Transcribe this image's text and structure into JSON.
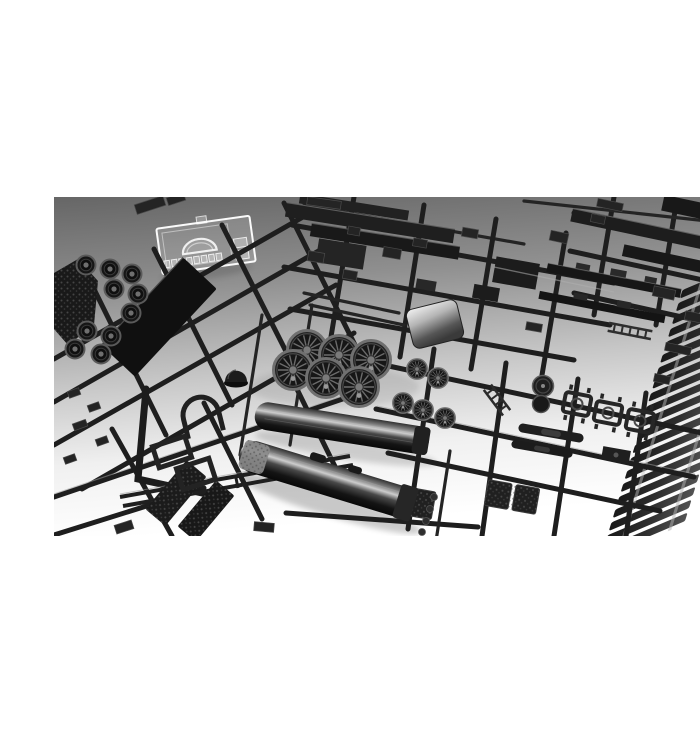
{
  "page": {
    "background": "#ffffff",
    "alt": "Product photograph of black injection-moulded plastic model-kit sprues for a steam locomotive: runners with spoked driver wheels, two glossy boiler halves, tender floor and side panels, coal load, smokebox door, ladders, bogie frames, a flexible track section with sleepers, and one clear glazing sprue, laid on a gray-to-white studio background."
  },
  "photo": {
    "description": "Steam locomotive model kit sprues on gradient studio backdrop",
    "background_top": "#666666",
    "background_upper": "#8f8f8f",
    "background_mid": "#c6c6c6",
    "background_lower": "#f0f0f0",
    "background_bottom": "#ffffff",
    "colors": {
      "plastic": "#1e1e1e",
      "plastic_highlight": "#9a9a9a",
      "clear_part": "#fafafa",
      "boiler_edge": "#303030",
      "boiler_light": "#7a7a7a",
      "boiler_sheen": "#cdcdcd",
      "boiler_mid": "#494949",
      "boiler_dark": "#141414",
      "boiler_deep": "#090909",
      "metal_bright": "#f2f2f2",
      "metal_mid": "#b5b5b5",
      "metal_shadow": "#565656",
      "metal_deep": "#3a3a3a",
      "tie_light": "#525252",
      "tie_mid": "#2e2e2e",
      "tie_dark": "#191919"
    },
    "parts": [
      {
        "label": "clear glazing sprue"
      },
      {
        "label": "tender disc wheels"
      },
      {
        "label": "coal load insert"
      },
      {
        "label": "tender floor panel"
      },
      {
        "label": "tender side beams"
      },
      {
        "label": "spoked driver wheels"
      },
      {
        "label": "boiler halves"
      },
      {
        "label": "smokebox wrapper"
      },
      {
        "label": "smokebox door"
      },
      {
        "label": "steam dome"
      },
      {
        "label": "cab window frames"
      },
      {
        "label": "chassis rails"
      },
      {
        "label": "ladders"
      },
      {
        "label": "bogie frames"
      },
      {
        "label": "slide bars"
      },
      {
        "label": "running boards"
      },
      {
        "label": "flexible track section"
      },
      {
        "label": "assorted detail parts on runners"
      }
    ]
  }
}
